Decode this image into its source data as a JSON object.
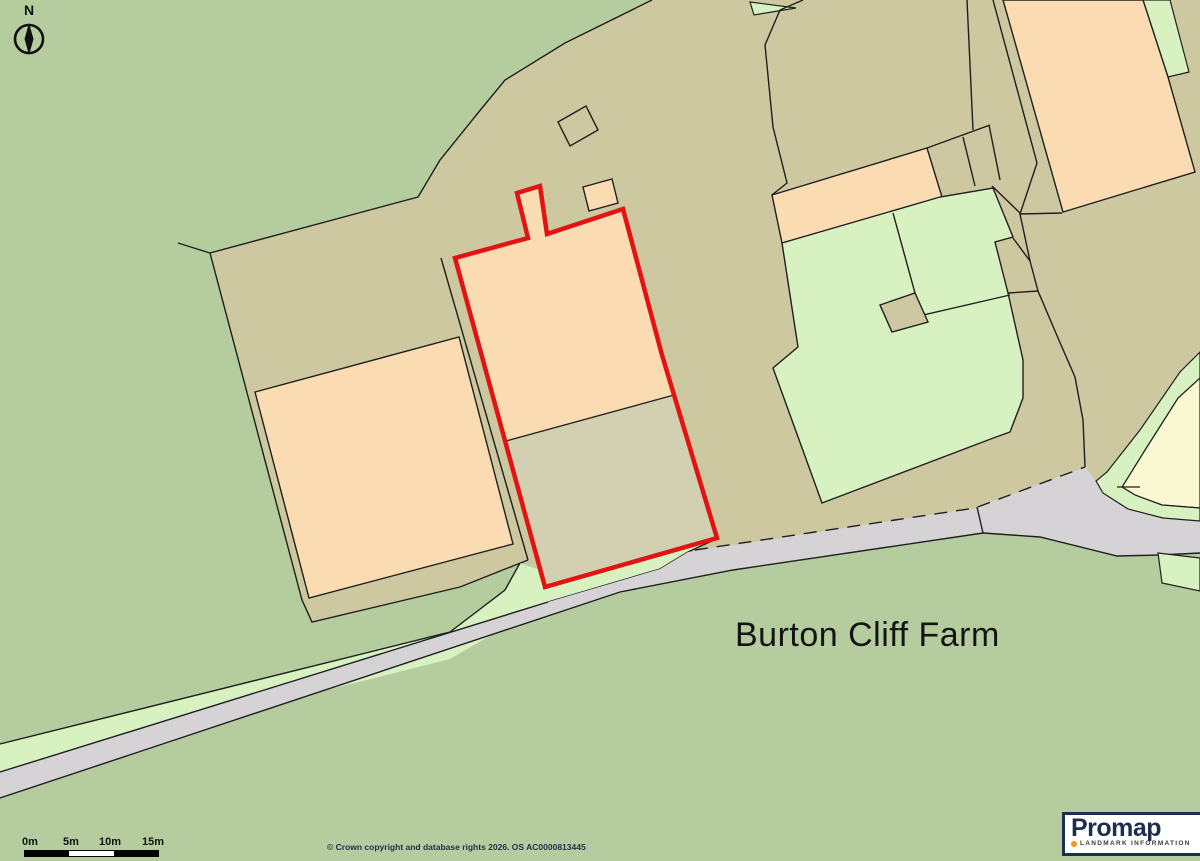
{
  "map": {
    "label": "Burton Cliff Farm",
    "colors": {
      "background_field_green": "#b5cd9e",
      "farmyard_tan": "#cec8a0",
      "building_peach": "#fbdcb2",
      "amenity_green": "#d7f2c0",
      "plot_yard_tan": "#d3d0b1",
      "pale_yellow_parcel": "#faf8d0",
      "road_gray": "#d5d3d5",
      "boundary_line": "#1f1f1f",
      "site_outline_red": "#e31313"
    },
    "shapes": [
      {
        "n": "field-background",
        "p": "0,0 1200,0 1200,861 0,861",
        "f": "#b5cd9e",
        "closed": true
      },
      {
        "n": "farmyard-area",
        "p": "652,0 565,43 505,80 482,108 440,160 418,197 210,253 302,600 312,622 460,587 528,560 548,602 660,569 688,552 975,508 1085,467 1096,481 1140,430 1180,372 1200,352 1200,0",
        "f": "#cec8a0",
        "closed": true
      },
      {
        "n": "farmyard-outline",
        "p": "652,0 565,43 505,80 482,108 440,160 418,197 210,253 302,600 312,622 460,587 528,560",
        "s": "#1f1f1f",
        "w": 1.4
      },
      {
        "n": "field-boundary-spur",
        "p": "178,243 210,253",
        "s": "#1f1f1f",
        "w": 1.4
      },
      {
        "n": "road-verge-green",
        "p": "0,744 450,632 505,590 520,563 540,570 545,587 714,540 688,552 660,569 548,602 450,659 0,772",
        "f": "#d7f2c0",
        "closed": true
      },
      {
        "n": "verge-top-line",
        "p": "0,744 450,632 505,590 520,563",
        "s": "#1f1f1f",
        "w": 1.4
      },
      {
        "n": "verge-curve-line",
        "p": "714,540 688,552 660,569 548,602",
        "s": "#1f1f1f",
        "w": 1.4
      },
      {
        "n": "road-surface",
        "p": "0,772 548,602 660,569 688,552 975,508 1085,467 1096,481 1103,493 1128,509 1163,518 1200,521 1200,553 1160,555 1117,556 1040,537 983,533 733,570 620,592 0,798",
        "f": "#d5d3d5",
        "closed": true
      },
      {
        "n": "road-top-edge",
        "p": "0,772 548,602",
        "s": "#1f1f1f",
        "w": 1.4
      },
      {
        "n": "road-dashed-edge",
        "p": "695,550 975,508 1085,467",
        "s": "#1f1f1f",
        "w": 1.4,
        "d": "13 9"
      },
      {
        "n": "road-junction-tick",
        "p": "977,507 983,533",
        "s": "#1f1f1f",
        "w": 1.4
      },
      {
        "n": "road-bottom-edge",
        "p": "0,798 620,592 733,570 983,533 1040,537 1117,556 1160,555 1200,553",
        "s": "#1f1f1f",
        "w": 1.4
      },
      {
        "n": "bottom-right-verge-strip",
        "p": "1158,553 1200,558 1200,591 1162,583",
        "f": "#d7f2c0",
        "s": "#1f1f1f",
        "w": 1.2,
        "closed": true
      },
      {
        "n": "topright-green-strip",
        "p": "1143,0 1170,0 1189,72 1168,77",
        "f": "#d7f2c0",
        "s": "#1f1f1f",
        "w": 1.2,
        "closed": true
      },
      {
        "n": "large-barn-topright",
        "p": "1003,0 1143,0 1168,77 1195,172 1063,212",
        "f": "#fbdcb2",
        "s": "#1f1f1f",
        "w": 1.4,
        "closed": true
      },
      {
        "n": "parcel-line-1",
        "p": "993,0 1037,163 1020,214 1062,213",
        "s": "#1f1f1f",
        "w": 1.4
      },
      {
        "n": "parcel-line-2",
        "p": "1020,214 1030,261 1038,291 1058,338 1075,377 1083,420 1085,467",
        "s": "#1f1f1f",
        "w": 1.4
      },
      {
        "n": "parcel-line-3",
        "p": "992,186 1020,213",
        "s": "#1f1f1f",
        "w": 1.4
      },
      {
        "n": "parcel-line-4",
        "p": "1013,238 1030,261",
        "s": "#1f1f1f",
        "w": 1.4
      },
      {
        "n": "parcel-line-5",
        "p": "1008,293 1038,291",
        "s": "#1f1f1f",
        "w": 1.4
      },
      {
        "n": "top-green-wedge",
        "p": "750,2 796,8 754,15",
        "f": "#d7f2c0",
        "s": "#1f1f1f",
        "w": 1.2,
        "closed": true
      },
      {
        "n": "top-parcel-divider",
        "p": "803,0 780,10 765,45 773,127 787,183 772,195",
        "s": "#1f1f1f",
        "w": 1.4
      },
      {
        "n": "track-line",
        "p": "967,0 973,130",
        "s": "#1f1f1f",
        "w": 1.4
      },
      {
        "n": "outbuilding-cells-top",
        "p": "927,148 990,125",
        "s": "#1f1f1f",
        "w": 1.4
      },
      {
        "n": "outbuilding-cell-line-1",
        "p": "963,137 975,186",
        "s": "#1f1f1f",
        "w": 1.4
      },
      {
        "n": "outbuilding-cell-line-2",
        "p": "989,125 1000,180",
        "s": "#1f1f1f",
        "w": 1.4
      },
      {
        "n": "long-barn-strip",
        "p": "772,195 927,148 942,197 782,243",
        "f": "#fbdcb2",
        "s": "#1f1f1f",
        "w": 1.4,
        "closed": true
      },
      {
        "n": "farmhouse-yard-green",
        "p": "782,243 940,197 993,188 1013,237 995,242 1008,293 1023,360 1023,398 1010,432 996,437 822,503 773,368 798,347",
        "f": "#d7f2c0",
        "s": "#1f1f1f",
        "w": 1.4,
        "closed": true
      },
      {
        "n": "yard-divider-line",
        "p": "893,213 915,293 923,315 1010,295",
        "s": "#1f1f1f",
        "w": 1.4
      },
      {
        "n": "yard-small-outbuilding",
        "p": "880,305 915,293 928,322 892,332",
        "f": "#cec8a0",
        "s": "#1f1f1f",
        "w": 1.4,
        "closed": true
      },
      {
        "n": "left-barn",
        "p": "255,392 459,337 513,544 309,598",
        "f": "#fbdcb2",
        "s": "#1f1f1f",
        "w": 1.4,
        "closed": true
      },
      {
        "n": "left-parcel-edge",
        "p": "441,258 528,560",
        "s": "#1f1f1f",
        "w": 1.4
      },
      {
        "n": "small-square-outbuilding",
        "p": "558,122 586,106 598,130 570,146",
        "f": "#cec8a0",
        "s": "#1f1f1f",
        "w": 1.4,
        "closed": true
      },
      {
        "n": "small-peach-outbuilding",
        "p": "583,187 612,179 618,203 589,211",
        "f": "#fbdcb2",
        "s": "#1f1f1f",
        "w": 1.4,
        "closed": true
      },
      {
        "n": "pale-yellow-parcel",
        "p": "1200,378 1178,398 1145,450 1122,487 1135,495 1162,505 1200,508",
        "f": "#faf8d0",
        "s": "#1f1f1f",
        "w": 1.2,
        "closed": true
      },
      {
        "n": "yellow-parcel-green-strip",
        "p": "1200,352 1180,372 1140,430 1107,472 1096,481 1103,493 1128,509 1163,518 1200,521 1200,508 1162,505 1135,495 1122,487 1145,450 1178,398 1200,378",
        "f": "#d7f2c0",
        "s": "#1f1f1f",
        "w": 1.2,
        "closed": true
      },
      {
        "n": "strip-inner-line",
        "p": "1117,487 1140,487",
        "s": "#1f1f1f",
        "w": 1.2
      },
      {
        "n": "site-building-peach",
        "p": "455,258 528,238 517,193 540,186 547,234 623,209 662,355 674,395 506,441",
        "f": "#fbdcb2",
        "closed": true
      },
      {
        "n": "site-yard-tan",
        "p": "506,441 674,395 717,538 545,587",
        "f": "#d3d0b1",
        "closed": true
      },
      {
        "n": "site-divider-line",
        "p": "506,441 674,395",
        "s": "#1f1f1f",
        "w": 1.3
      },
      {
        "n": "site-red-boundary",
        "p": "455,258 528,238 517,193 540,186 547,234 623,209 662,355 717,538 545,587",
        "s": "#e31313",
        "w": 4.5,
        "closed": true
      }
    ]
  },
  "compass": {
    "label": "N"
  },
  "scalebar": {
    "labels": [
      "0m",
      "5m",
      "10m",
      "15m"
    ]
  },
  "footer": {
    "copyright": "© Crown copyright and database rights 2026. OS AC0000813445"
  },
  "logo": {
    "brand": "Promap",
    "sub": "LANDMARK INFORMATION"
  }
}
